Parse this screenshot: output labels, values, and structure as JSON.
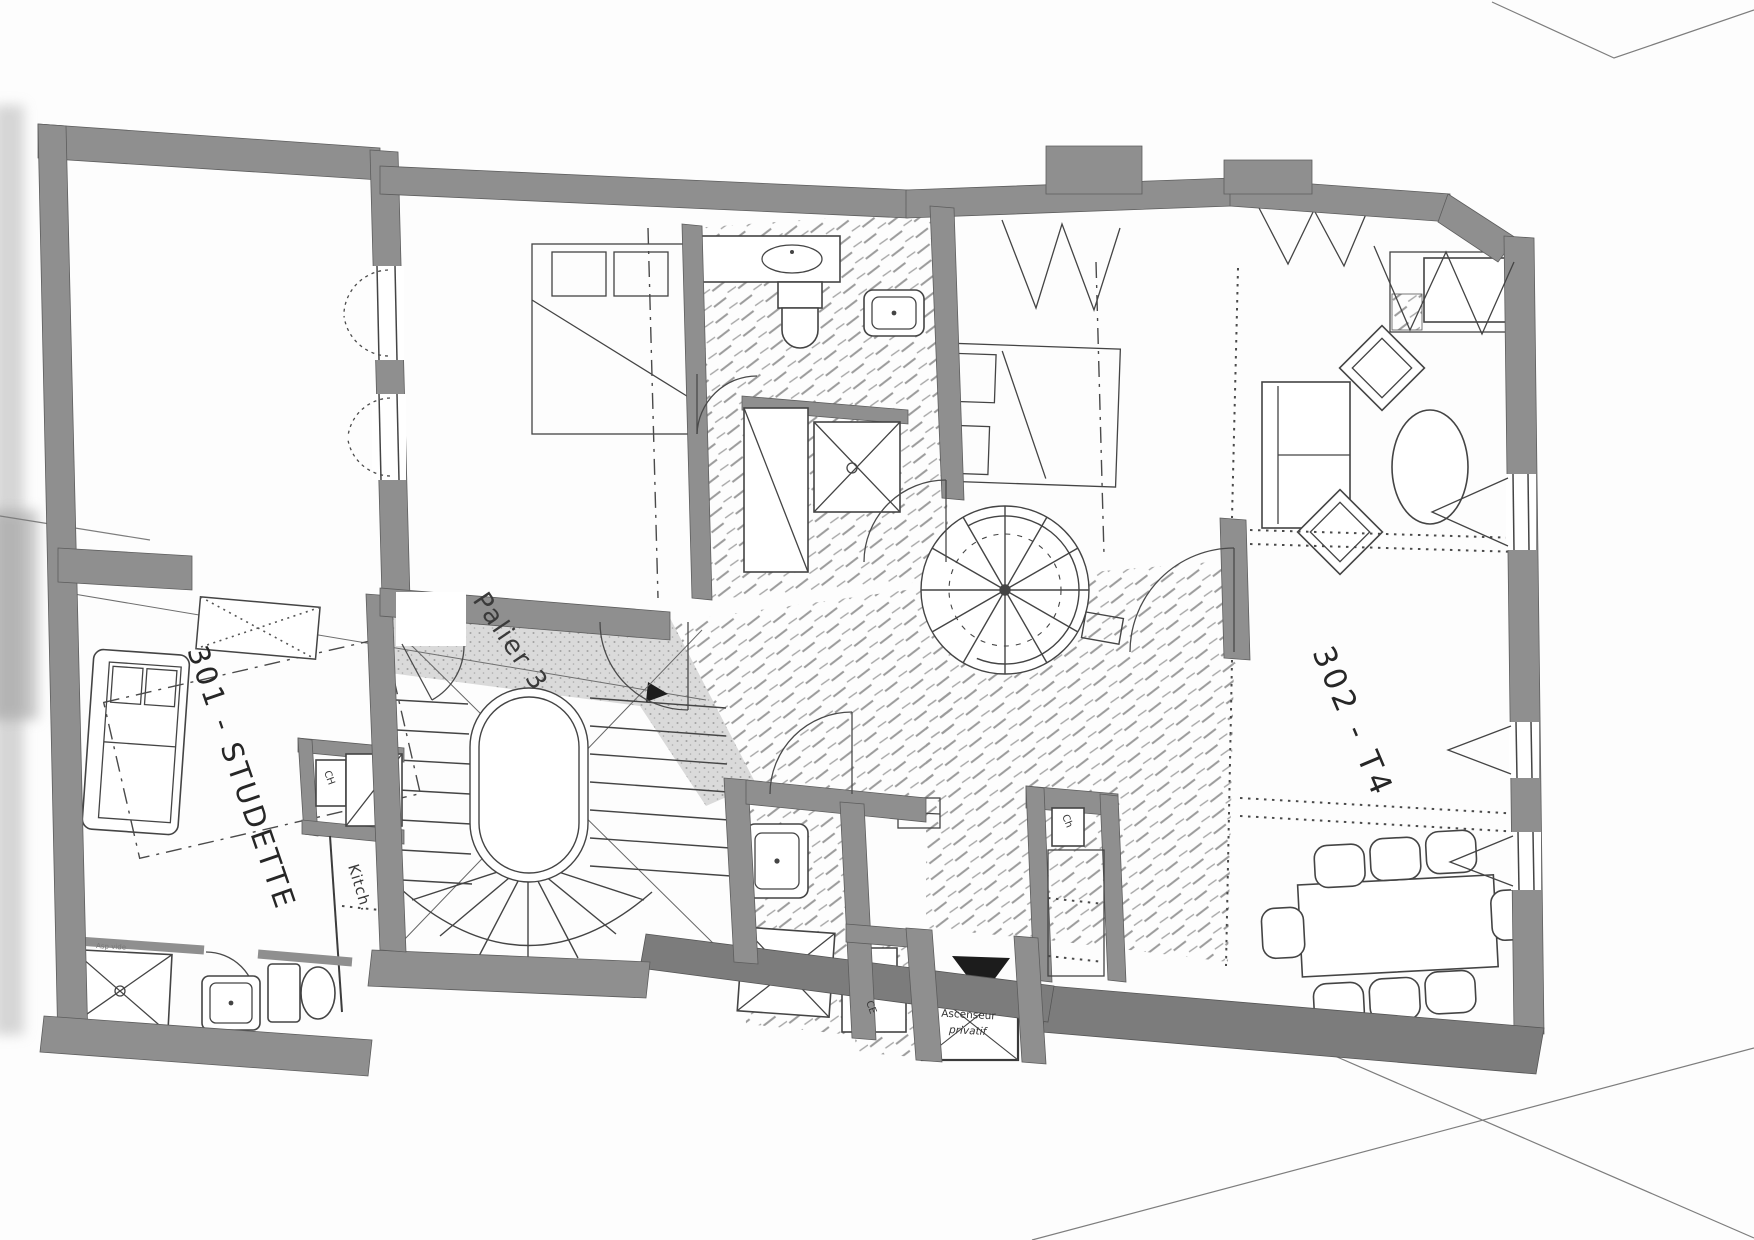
{
  "document_type": "scanned-floor-plan",
  "labels": {
    "unit_301": "301 - STUDETTE",
    "unit_302": "302 - T4",
    "landing": "Palier 3",
    "kitchen": "Kitch.",
    "water_heater_upper": "CH",
    "water_heater_lower": "Ch",
    "hot_water_ce": "CE",
    "elevator_line1": "Ascenseur",
    "elevator_line2": "privatif",
    "corner_note": "Asp vide"
  },
  "colors": {
    "paper": "#fdfdfd",
    "wall": "#8f8f8f",
    "wall_dark": "#7c7c7c",
    "linework": "#444444",
    "text": "#2e2e2e",
    "stipple_bg": "#dadada",
    "stipple_dot": "#a2a2a2",
    "hatch": "#9b9b9b",
    "arrow_fill": "#1c1c1c"
  },
  "rooms": [
    {
      "id": "studette-301",
      "label_key": "unit_301"
    },
    {
      "id": "apartment-302",
      "label_key": "unit_302"
    },
    {
      "id": "landing-palier-3",
      "label_key": "landing"
    },
    {
      "id": "kitchenette",
      "label_key": "kitchen"
    }
  ],
  "fixtures": [
    "main-staircase",
    "spiral-staircase",
    "private-elevator",
    "shower",
    "toilet",
    "sink",
    "vanity",
    "double-bed",
    "sofa",
    "oval-coffee-table",
    "armchair",
    "dining-table",
    "dining-chair",
    "wardrobe-closet",
    "water-heater",
    "fireplace-alcove",
    "window-casement",
    "curtained-window",
    "door-swing"
  ]
}
